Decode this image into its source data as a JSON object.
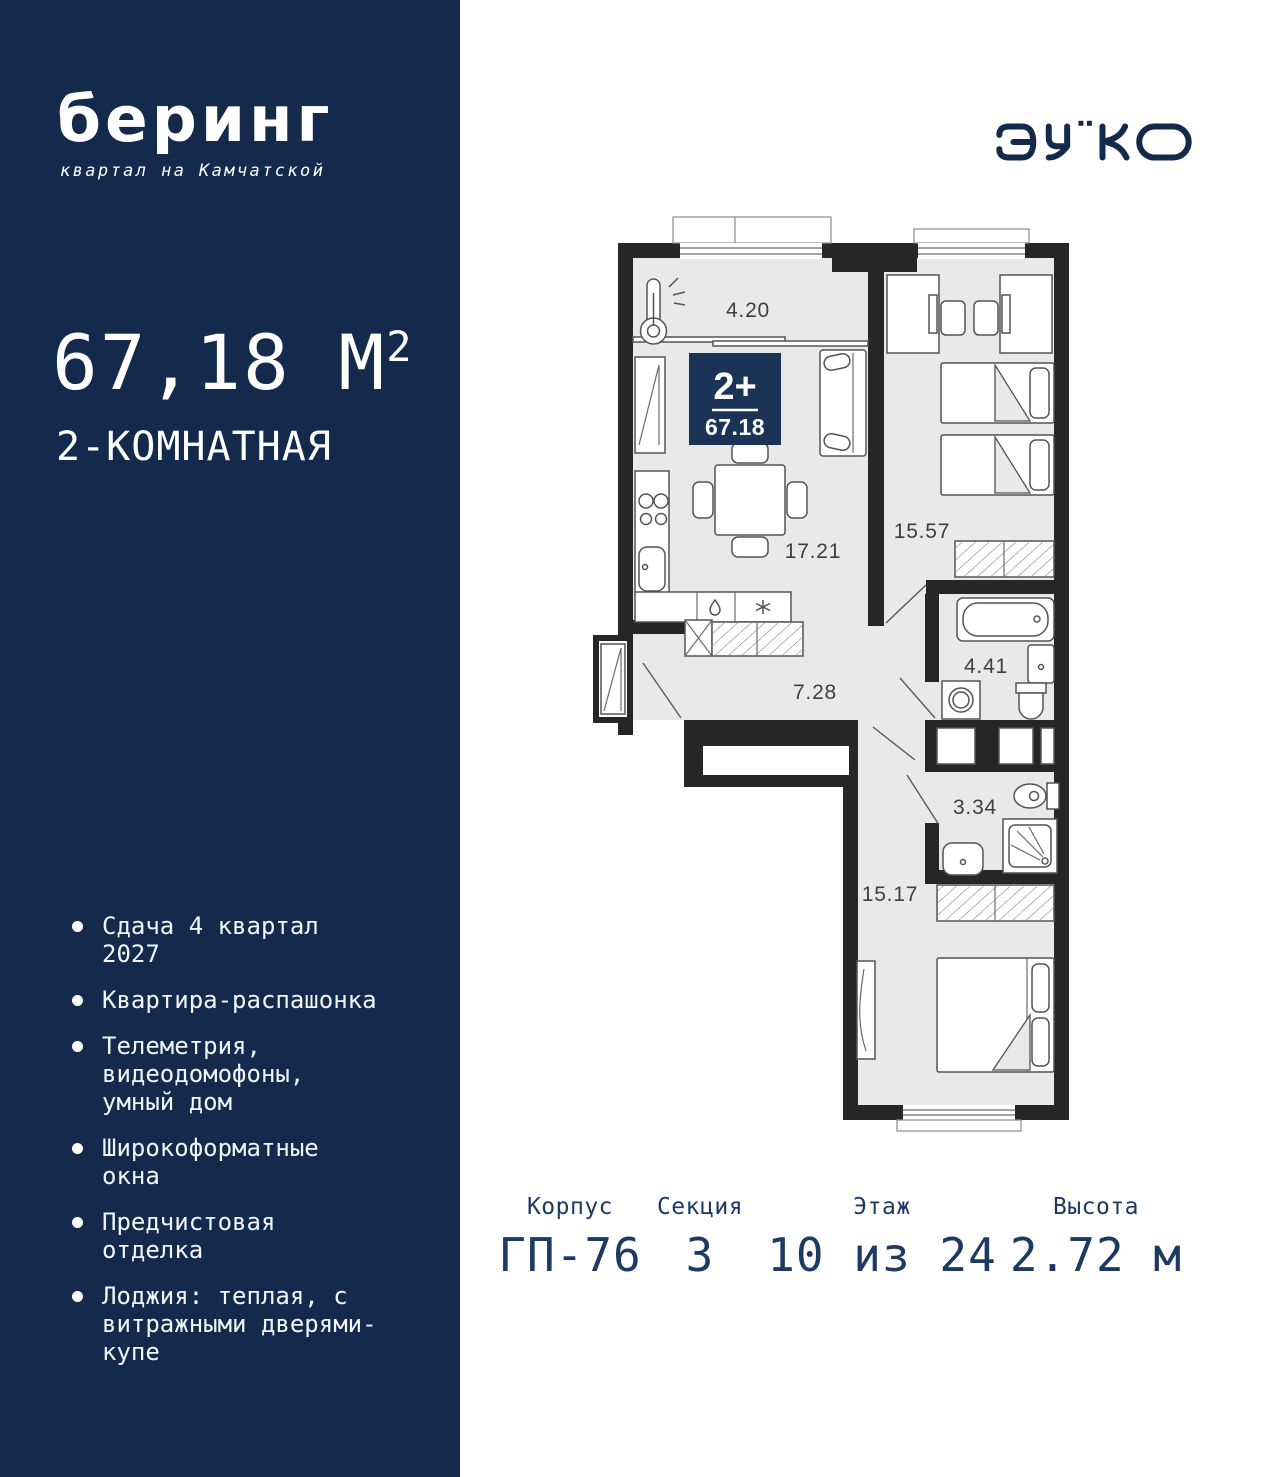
{
  "sidebar": {
    "brand": {
      "name": "беринг",
      "tagline": "квартал на Камчатской"
    },
    "area": {
      "value": "67,18 М",
      "sup": "2"
    },
    "type": "2-КОМНАТНАЯ",
    "features": [
      "Сдача 4 квартал 2027",
      "Квартира-распашонка",
      "Телеметрия, видеодомофоны, умный дом",
      "Широкоформатные окна",
      "Предчистовая отделка",
      "Лоджия: теплая, с витражными дверями-купе"
    ]
  },
  "developer": {
    "name": "ЭНКО"
  },
  "plan": {
    "badge": {
      "rooms": "2+",
      "area": "67.18"
    },
    "rooms": {
      "balcony": "4.20",
      "kitchen_living": "17.21",
      "bedroom_top": "15.57",
      "bathroom": "4.41",
      "hallway": "7.28",
      "wc": "3.34",
      "bedroom_bottom": "15.17"
    }
  },
  "info": {
    "columns": [
      {
        "label": "Корпус",
        "value": "ГП-76"
      },
      {
        "label": "Секция",
        "value": "3"
      },
      {
        "label": "Этаж",
        "value": "10 из 24"
      },
      {
        "label": "Высота",
        "value": "2.72 м"
      }
    ]
  },
  "colors": {
    "navy": "#142a4c",
    "badge": "#1a3457",
    "wall": "#262626",
    "floor": "#e9e9e9"
  }
}
